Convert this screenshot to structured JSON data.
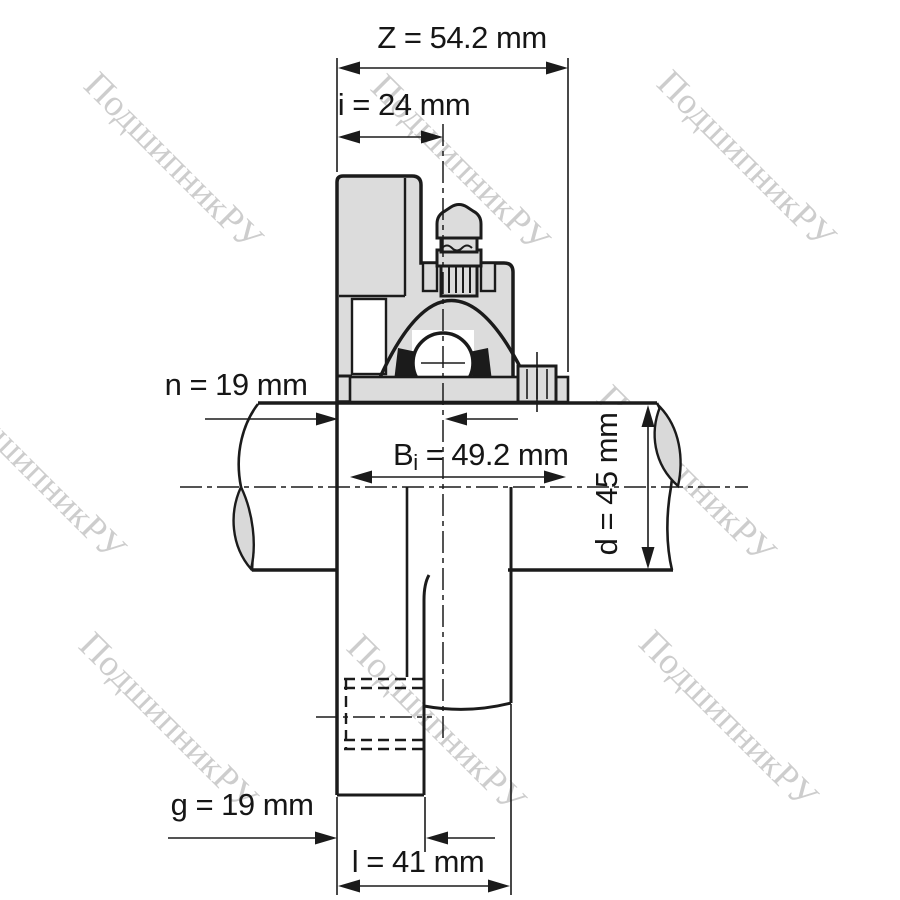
{
  "watermark": {
    "text": "ПодшипникРУ",
    "color": "#c5c5c5"
  },
  "dimensions": {
    "z": {
      "label": "Z = 54.2 mm"
    },
    "i": {
      "label": "i = 24 mm"
    },
    "n": {
      "label": "n = 19 mm"
    },
    "bi": {
      "prefix": "B",
      "sub": "i",
      "rest": " = 49.2 mm"
    },
    "d": {
      "label": "d = 45 mm"
    },
    "g": {
      "label": "g = 19 mm"
    },
    "l": {
      "label": "l = 41 mm"
    }
  },
  "colors": {
    "line": "#1b1b1b",
    "section_fill": "#dcdcdc",
    "break_lens_fill": "#d9d9d9",
    "background": "#ffffff",
    "watermark": "#c5c5c5",
    "dimension_text": "#161616"
  }
}
